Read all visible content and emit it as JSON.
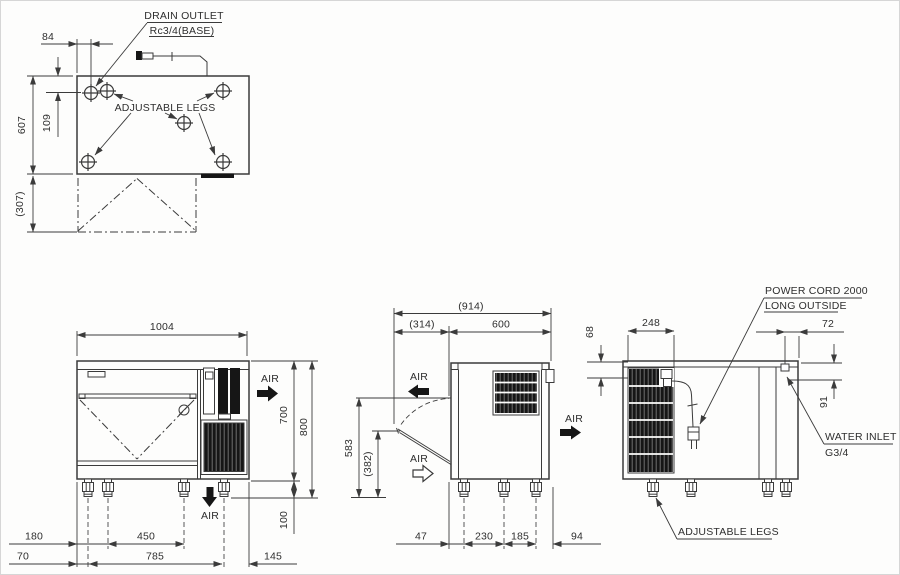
{
  "colors": {
    "line": "#3b3b3b",
    "dark_fill": "#161616",
    "background": "#fdfdfc"
  },
  "top_view": {
    "drain_outlet_line1": "DRAIN OUTLET",
    "drain_outlet_line2": "Rc3/4(BASE)",
    "adjustable_legs_label": "ADJUSTABLE LEGS",
    "dim_84": "84",
    "dim_607": "607",
    "dim_109": "109",
    "dim_307": "(307)"
  },
  "front_view": {
    "dim_1004": "1004",
    "air_side_label": "AIR",
    "air_bottom_label": "AIR",
    "dim_700": "700",
    "dim_800": "800",
    "dim_100": "100",
    "dim_180": "180",
    "dim_450": "450",
    "dim_70": "70",
    "dim_785": "785",
    "dim_145": "145"
  },
  "side_view": {
    "dim_914": "(914)",
    "dim_314": "(314)",
    "dim_600": "600",
    "air_top_label": "AIR",
    "air_front_label": "AIR",
    "air_out_label": "AIR",
    "dim_583": "583",
    "dim_382": "(382)",
    "dim_47": "47",
    "dim_230": "230",
    "dim_185": "185",
    "dim_94": "94"
  },
  "rear_view": {
    "dim_68": "68",
    "dim_248": "248",
    "dim_72": "72",
    "dim_91": "91",
    "power_cord_line1": "POWER CORD 2000",
    "power_cord_line2": "LONG OUTSIDE",
    "water_inlet_line1": "WATER INLET",
    "water_inlet_line2": "G3/4",
    "adjustable_legs_label": "ADJUSTABLE LEGS"
  }
}
